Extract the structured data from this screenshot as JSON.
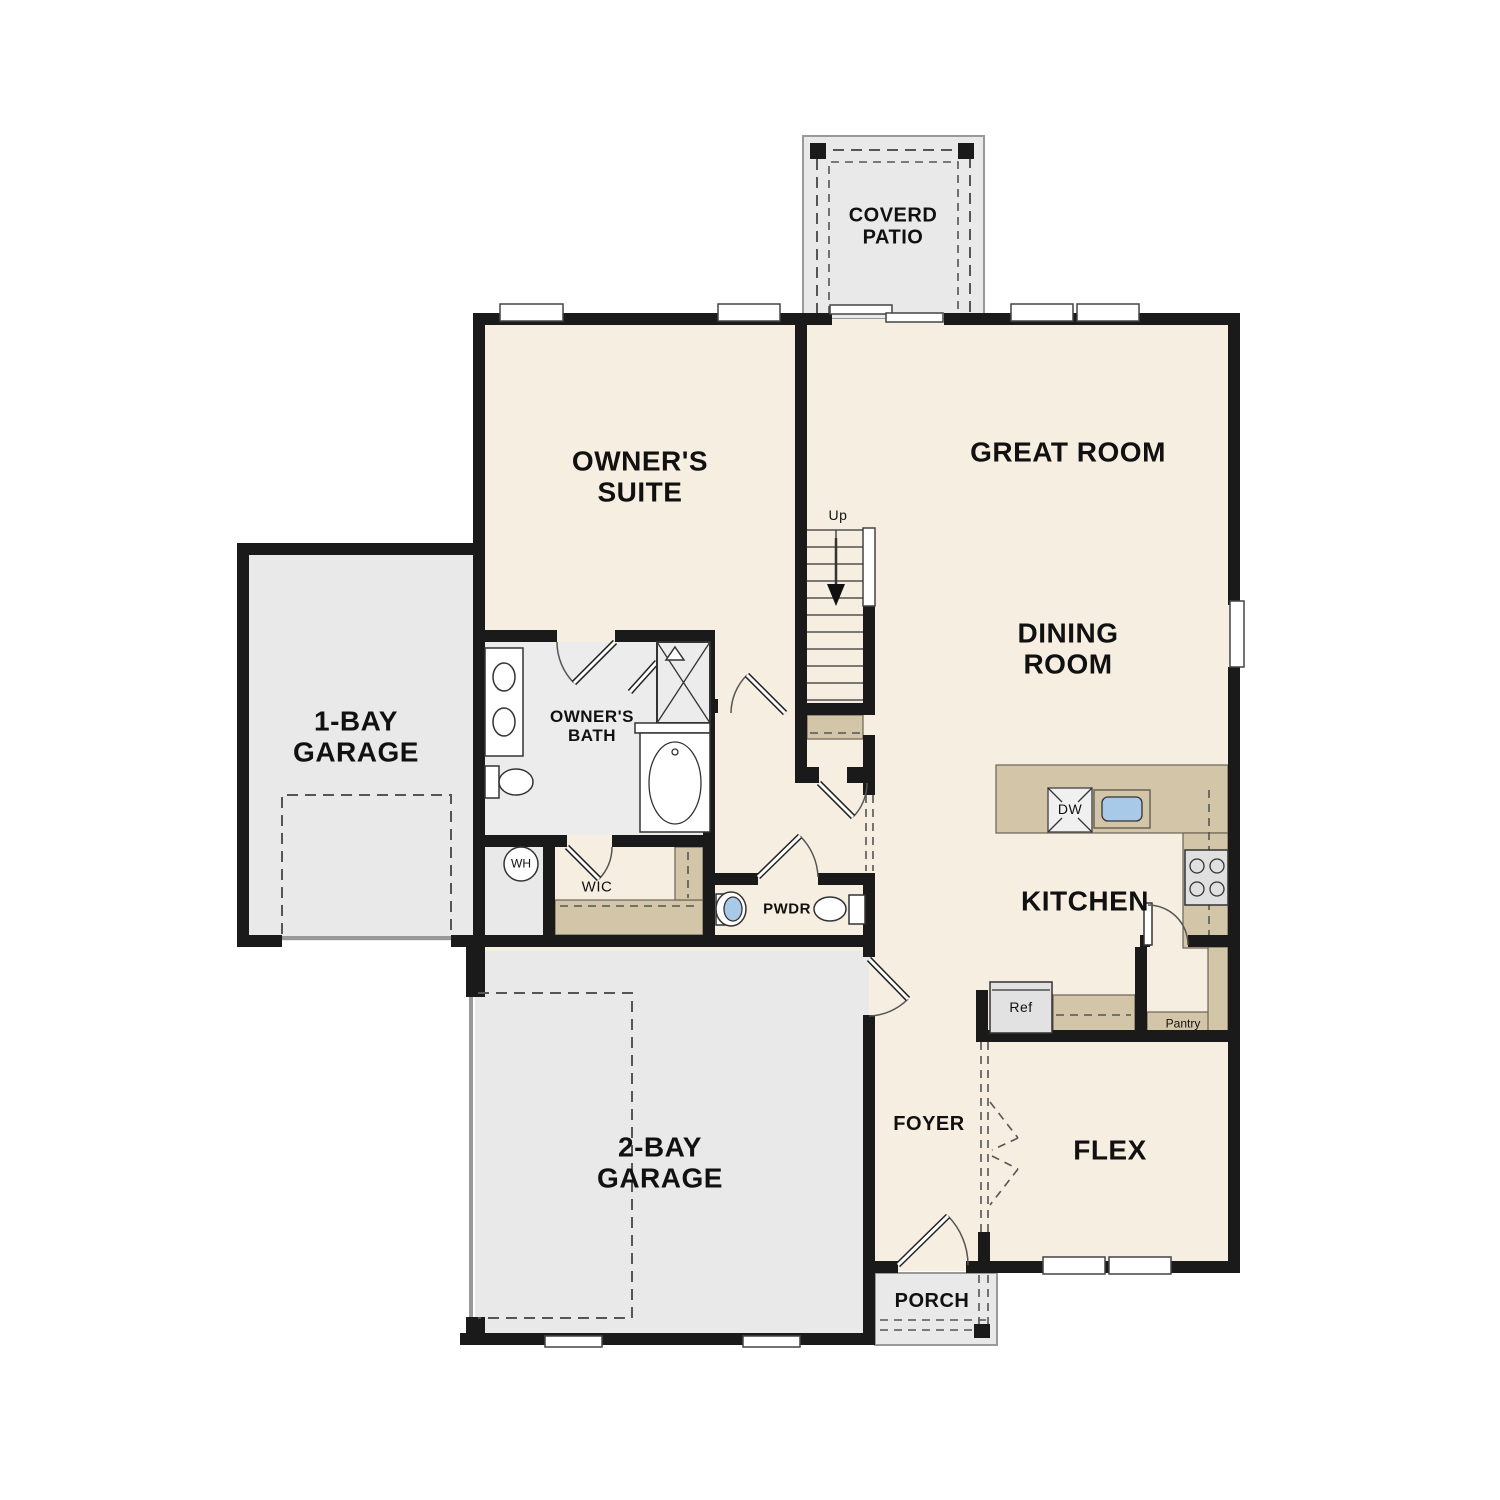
{
  "title": "First floor plan",
  "colors": {
    "wall": "#1a1a1a",
    "floor_main": "#f6eee1",
    "floor_garage": "#e9e9e9",
    "floor_bath": "#ececec",
    "counter": "#d3c5a8",
    "water": "#a9c9e9",
    "window": "#ffffff"
  },
  "rooms": {
    "covered_patio": {
      "line1": "COVERD",
      "line2": "PATIO"
    },
    "owners_suite": {
      "line1": "OWNER'S",
      "line2": "SUITE"
    },
    "great_room": {
      "line1": "GREAT ROOM"
    },
    "dining_room": {
      "line1": "DINING",
      "line2": "ROOM"
    },
    "garage_1bay": {
      "line1": "1-BAY",
      "line2": "GARAGE"
    },
    "owners_bath": {
      "line1": "OWNER'S",
      "line2": "BATH"
    },
    "wic": {
      "line1": "WIC"
    },
    "powder": {
      "line1": "PWDR"
    },
    "kitchen": {
      "line1": "KITCHEN"
    },
    "garage_2bay": {
      "line1": "2-BAY",
      "line2": "GARAGE"
    },
    "foyer": {
      "line1": "FOYER"
    },
    "flex": {
      "line1": "FLEX"
    },
    "porch": {
      "line1": "PORCH"
    }
  },
  "fixtures": {
    "stairs_direction": "Up",
    "water_heater": "WH",
    "dishwasher": "DW",
    "refrigerator": "Ref",
    "pantry": "Pantry"
  }
}
